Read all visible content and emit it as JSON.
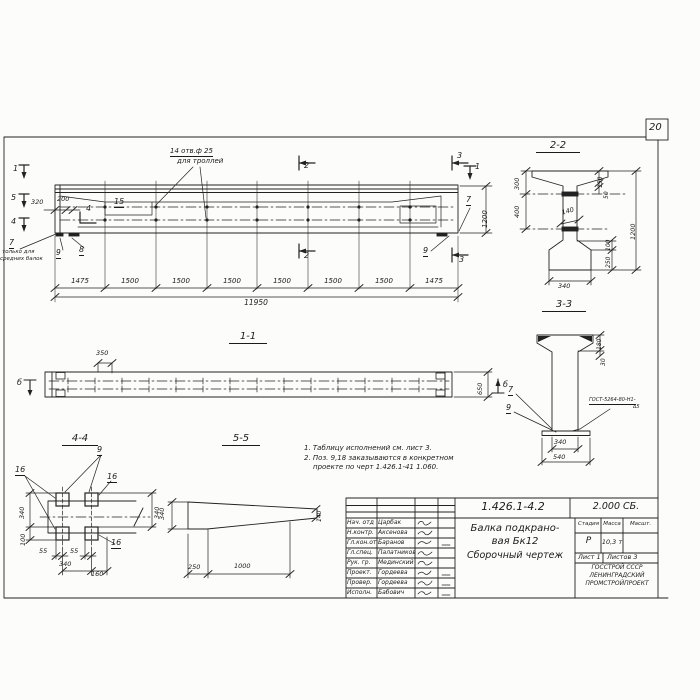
{
  "sheet": {
    "page_number": "20"
  },
  "elevation": {
    "cut1_left": "1",
    "cut5_left": "5",
    "cut4_left": "4",
    "cut4_inner": "4",
    "cut2_top": "2",
    "cut2_bottom": "2",
    "cut3_top": "3",
    "cut3_bottom": "3",
    "cut1_right": "1",
    "hole_note1": "14 отв.ф 25",
    "hole_note2": "для троллей",
    "dim_320": "320",
    "dim_200": "200",
    "pos_15": "15",
    "pos_7_right": "7",
    "pos_9_right": "9",
    "pos_7_left": "7",
    "only_note1": "только для",
    "only_note2": "средних балок",
    "pos_9_left": "9",
    "pos_8_left": "8",
    "dim_1200": "1200",
    "segments": [
      "1475",
      "1500",
      "1500",
      "1500",
      "1500",
      "1500",
      "1500",
      "1475"
    ],
    "dim_total": "11950"
  },
  "section22": {
    "title": "2-2",
    "d300": "300",
    "d400": "400",
    "d150": "150",
    "d50": "50",
    "d140": "140",
    "d1200": "1200",
    "d100": "100",
    "d250": "250",
    "d340": "340"
  },
  "section33": {
    "title": "3-3",
    "d180": "180",
    "d30": "30",
    "d340": "340",
    "d540": "540",
    "pos7": "7",
    "pos9": "9",
    "weld1": "ГОСТ-5264-80-Н1-",
    "weld2": "∆5"
  },
  "section11": {
    "title": "1-1",
    "d350": "350",
    "d650": "650",
    "cut_b_left": "б",
    "cut_b_right": "б"
  },
  "view44": {
    "title": "4-4",
    "pos9": "9",
    "pos16_left": "16",
    "pos16_right": "16",
    "pos16_bottom": "16",
    "d340_left": "340",
    "d100": "100",
    "d55a": "55",
    "d55b": "55",
    "d340_bottom": "340",
    "d160": "160",
    "d340_right": "340"
  },
  "view55": {
    "title": "5-5",
    "d340": "340",
    "d140": "140",
    "d250": "250",
    "d1000": "1000"
  },
  "notes": {
    "n1": "1. Таблицу исполнений см. лист 3.",
    "n2": "2. Поз. 9,18 заказываются в конкретном",
    "n3": "проекте по черт 1.426.1-41 1.060."
  },
  "titleblock": {
    "doc_number": "1.426.1-4.2",
    "doc_code": "2.000 СБ.",
    "name1": "Балка подкрано-",
    "name2": "вая Бк12",
    "name3": "Сборочный чертеж",
    "h_stage": "Стадия",
    "h_mass": "Масса",
    "h_scale": "Масшт.",
    "stage": "Р",
    "mass": "10,3 т",
    "sheet": "Лист 1",
    "sheets": "Листов 3",
    "org1": "ГОССТРОЙ СССР",
    "org2": "ЛЕНИНГРАДСКИЙ",
    "org3": "ПРОМСТРОЙПРОЕКТ",
    "staff": [
      {
        "role": "Нач. отд",
        "name": "Царбак"
      },
      {
        "role": "Н.контр.",
        "name": "Аксенова"
      },
      {
        "role": "Гл.кон.от",
        "name": "Баранов"
      },
      {
        "role": "Гл.спец.",
        "name": "Палатников"
      },
      {
        "role": "Рук. гр.",
        "name": "Мединский"
      },
      {
        "role": "Проект.",
        "name": "Гордеева"
      },
      {
        "role": "Провер.",
        "name": "Гордеева"
      },
      {
        "role": "Исполн.",
        "name": "Бабович"
      }
    ]
  }
}
